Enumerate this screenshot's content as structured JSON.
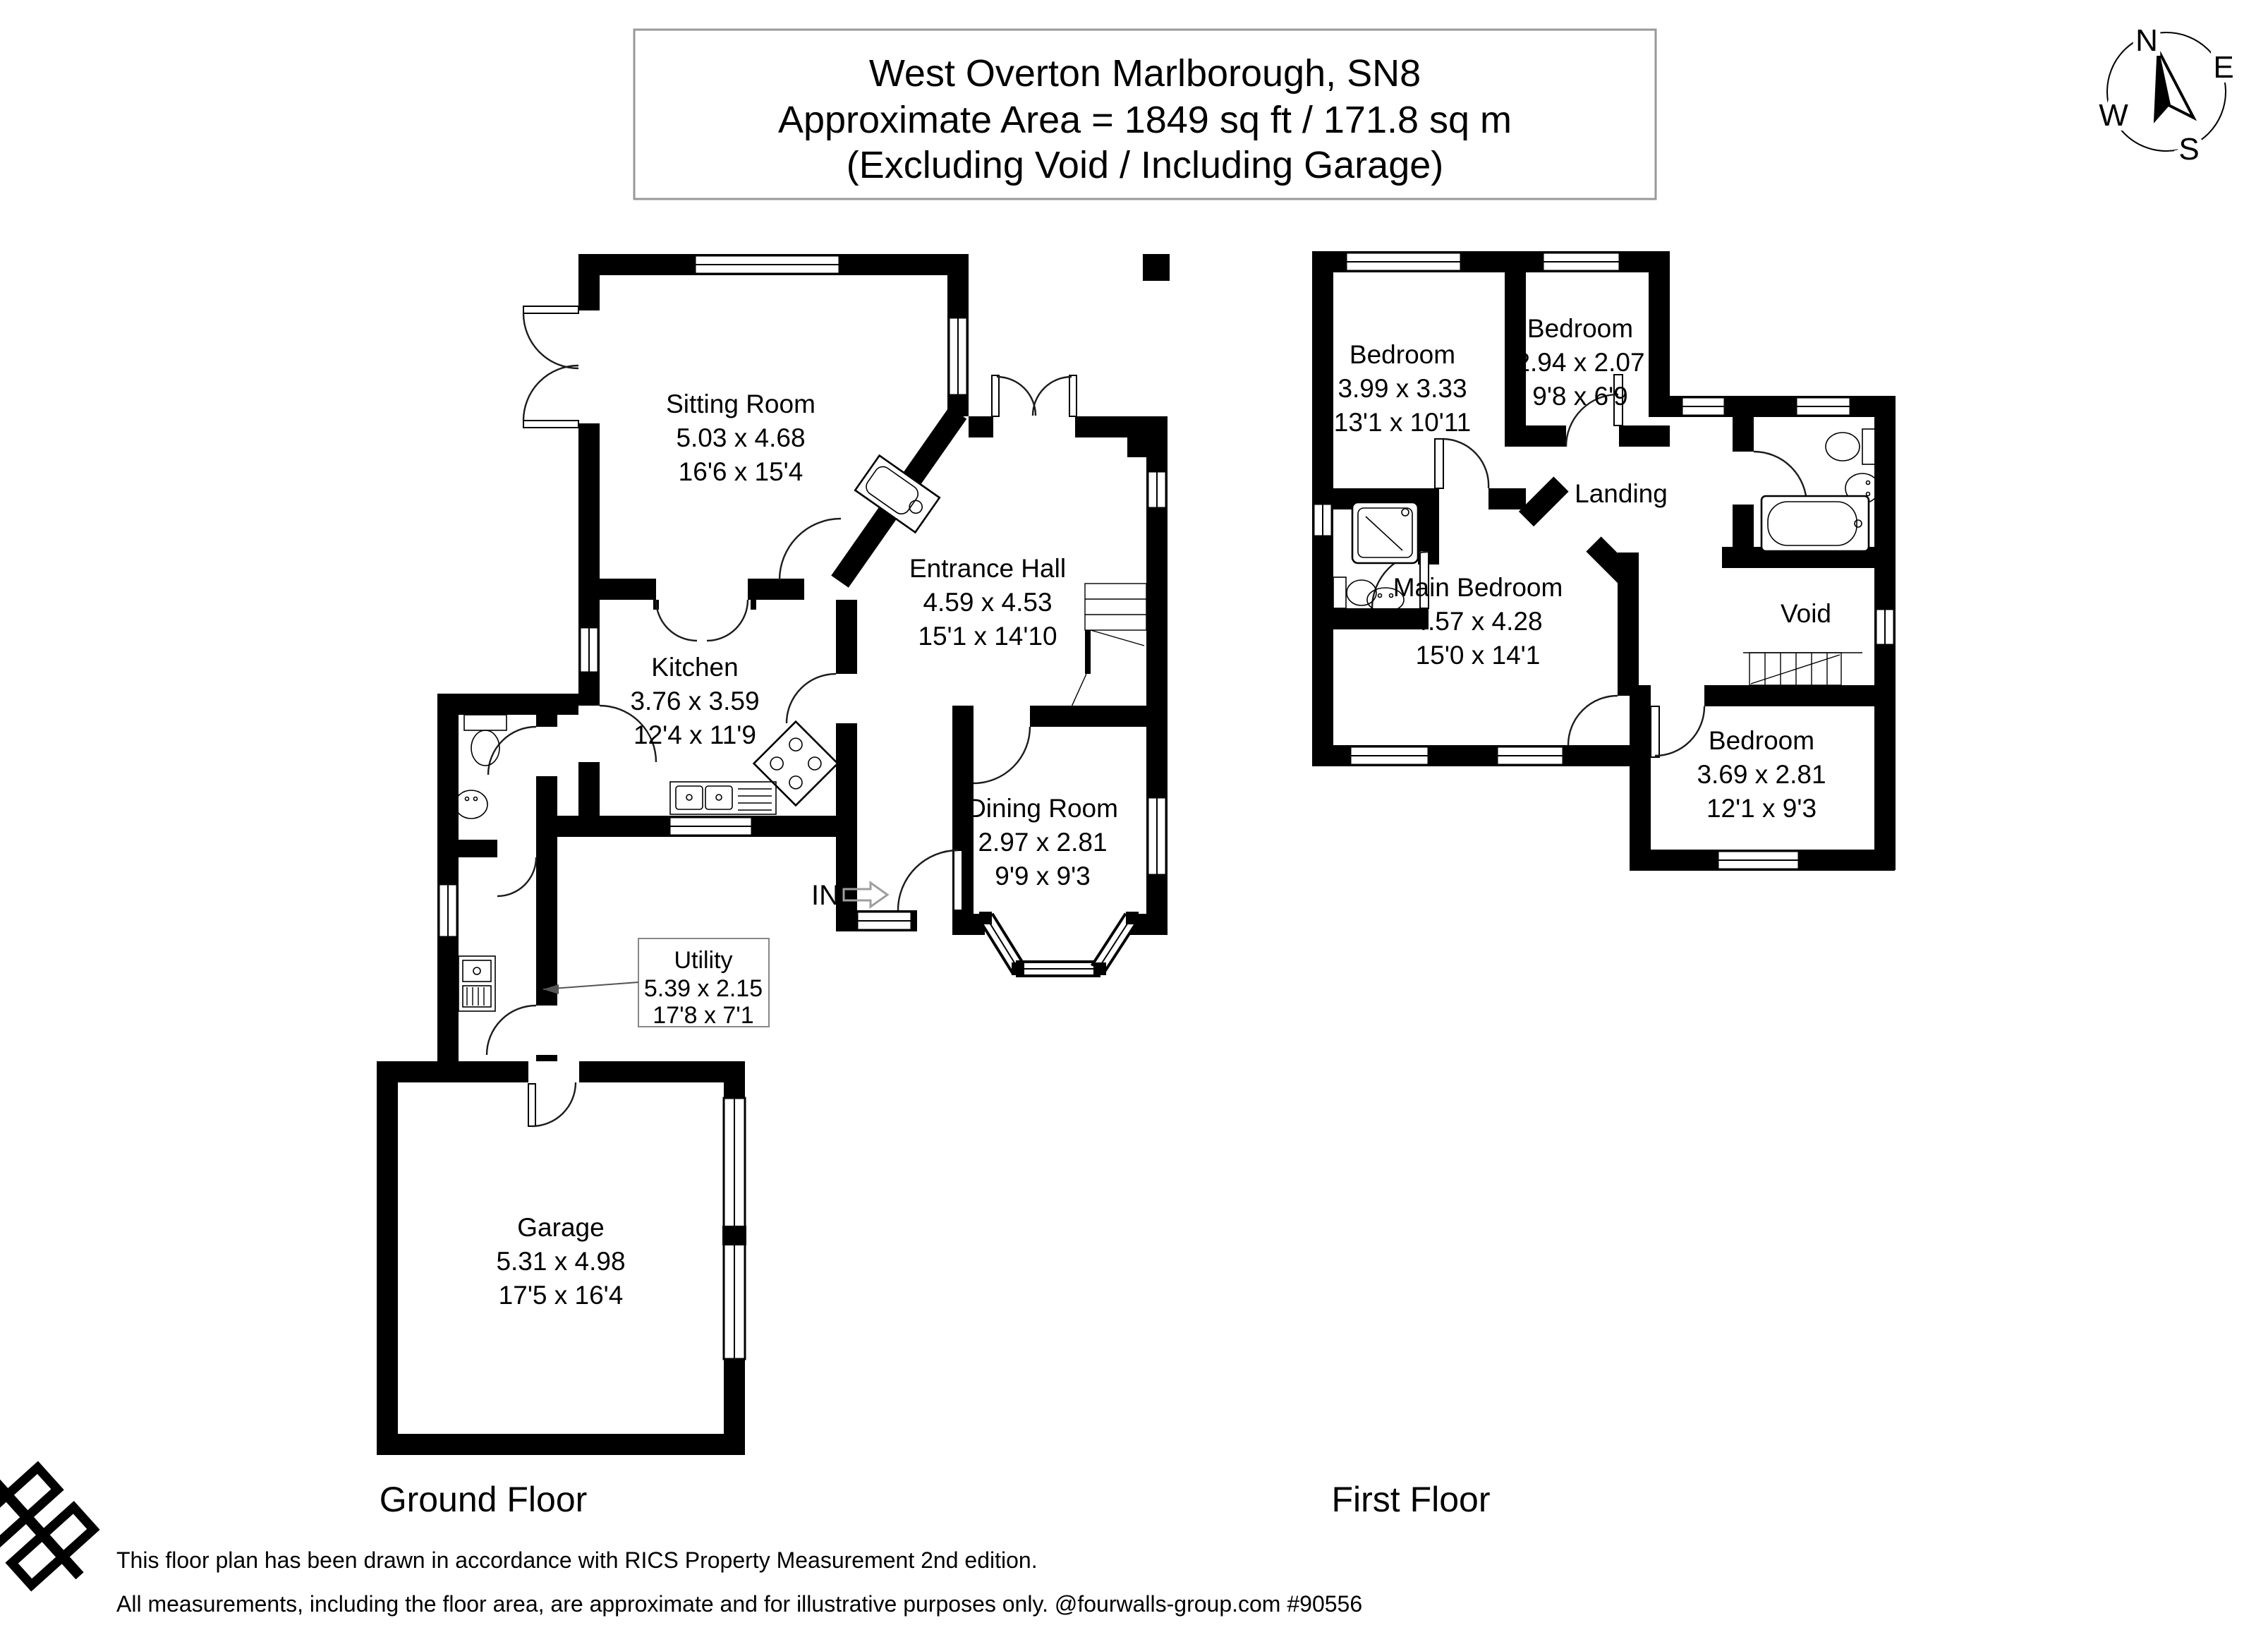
{
  "title": {
    "line1": "West Overton Marlborough, SN8",
    "line2": "Approximate Area = 1849 sq ft / 171.8 sq m",
    "line3": "(Excluding Void / Including Garage)"
  },
  "compass": {
    "north": "N",
    "east": "E",
    "south": "S",
    "west": "W"
  },
  "ground_floor": {
    "label": "Ground Floor",
    "entrance_marker": "IN",
    "rooms": {
      "sitting_room": {
        "name": "Sitting Room",
        "metric": "5.03 x 4.68",
        "imperial": "16'6 x 15'4"
      },
      "entrance_hall": {
        "name": "Entrance Hall",
        "metric": "4.59 x 4.53",
        "imperial": "15'1 x 14'10"
      },
      "kitchen": {
        "name": "Kitchen",
        "metric": "3.76 x 3.59",
        "imperial": "12'4 x 11'9"
      },
      "dining_room": {
        "name": "Dining Room",
        "metric": "2.97 x 2.81",
        "imperial": "9'9 x 9'3"
      },
      "utility": {
        "name": "Utility",
        "metric": "5.39 x 2.15",
        "imperial": "17'8 x 7'1"
      },
      "garage": {
        "name": "Garage",
        "metric": "5.31 x 4.98",
        "imperial": "17'5 x 16'4"
      }
    }
  },
  "first_floor": {
    "label": "First Floor",
    "rooms": {
      "bedroom_1": {
        "name": "Bedroom",
        "metric": "3.99 x 3.33",
        "imperial": "13'1 x 10'11"
      },
      "bedroom_2": {
        "name": "Bedroom",
        "metric": "2.94 x 2.07",
        "imperial": "9'8 x 6'9"
      },
      "landing": {
        "name": "Landing"
      },
      "main_bedroom": {
        "name": "Main Bedroom",
        "metric": "4.57 x 4.28",
        "imperial": "15'0 x 14'1"
      },
      "void": {
        "name": "Void"
      },
      "bedroom_3": {
        "name": "Bedroom",
        "metric": "3.69 x 2.81",
        "imperial": "12'1 x 9'3"
      }
    }
  },
  "footer": {
    "line1": "This floor plan has been drawn in accordance with RICS Property Measurement 2nd edition.",
    "line2": "All measurements, including the floor area, are approximate and for illustrative purposes only. @fourwalls-group.com #90556"
  },
  "colors": {
    "wall": "#000000",
    "background": "#ffffff",
    "title_box_border": "#999999",
    "leader_line": "#555555",
    "in_arrow": "#9e9e9e"
  }
}
